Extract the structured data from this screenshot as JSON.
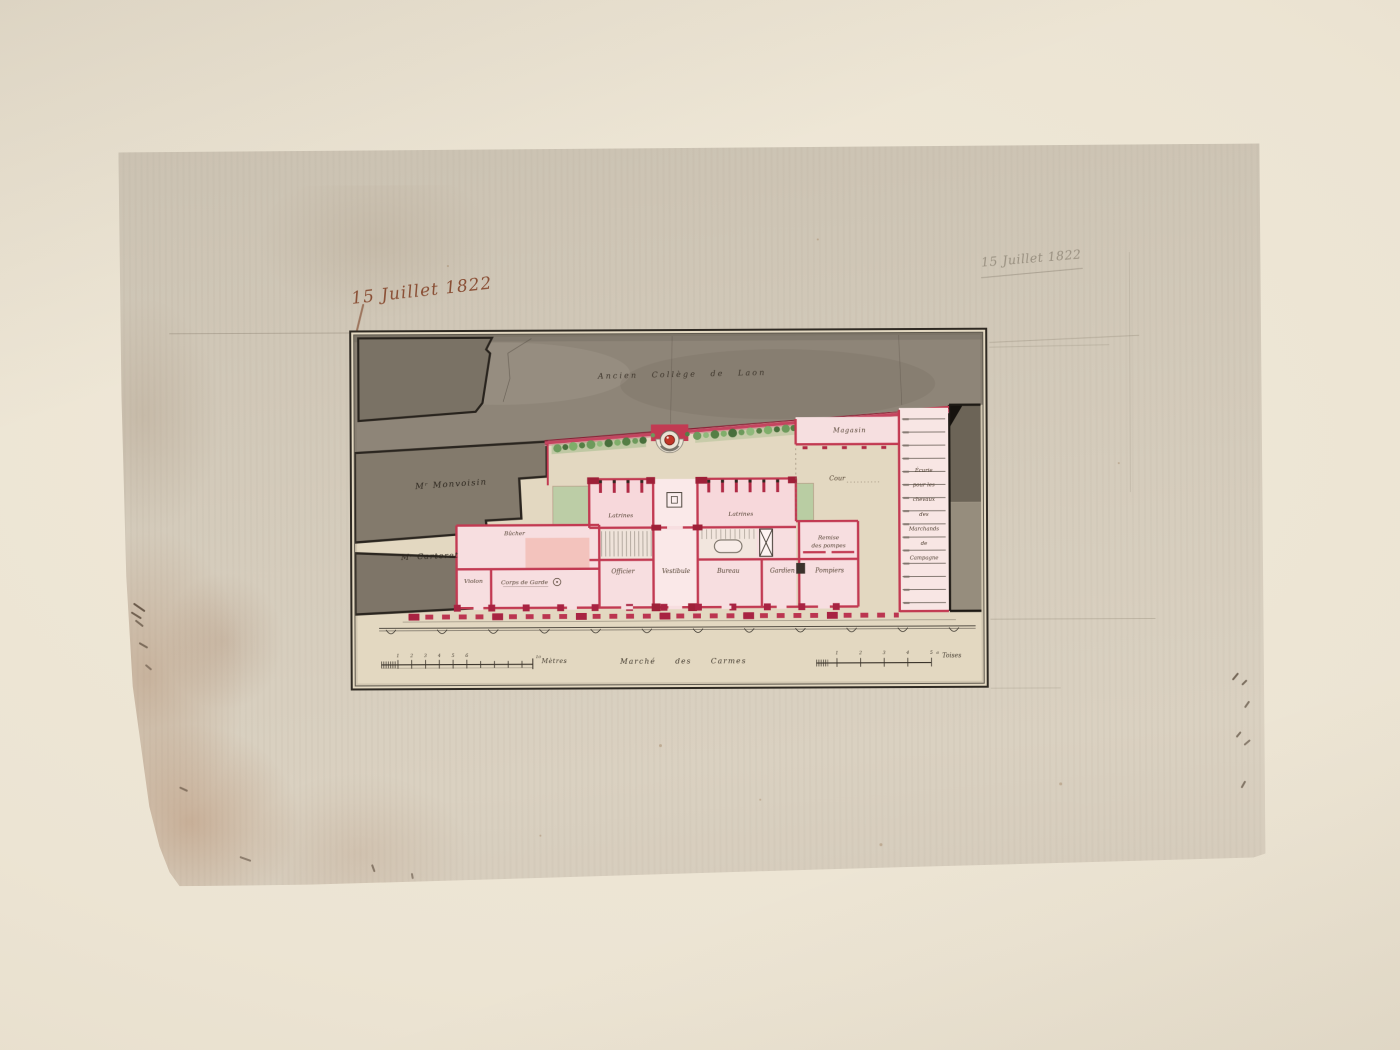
{
  "photo": {
    "inscriptions": {
      "date_ink": "15 Juillet 1822",
      "date_pencil": "15 Juillet 1822"
    },
    "plan": {
      "site_label": "Ancien Collège de Laon",
      "neighbor_left_upper": "Mʳ Monvoisin",
      "neighbor_left_lower": "Mʳ Carteret",
      "street_label": "Marché des Carmes",
      "rooms": {
        "bucher": "Bûcher",
        "violon": "Violon",
        "corps_de_garde": "Corps de Garde",
        "latrines_left": "Latrines",
        "latrines_right": "Latrines",
        "officier": "Officier",
        "vestibule": "Vestibule",
        "bureau": "Bureau",
        "gardien": "Gardien",
        "remise_line1": "Remise",
        "remise_line2": "des pompes",
        "pompiers": "Pompiers",
        "magasin": "Magasin",
        "cour": "Cour",
        "ecurie_lines": [
          "Écurie",
          "pour les",
          "chevaux",
          "des",
          "Marchands",
          "de",
          "Campagne"
        ]
      },
      "scale_left": {
        "numbers": [
          "1",
          "2",
          "3",
          "4",
          "5",
          "6"
        ],
        "end_value": "10",
        "unit": "Mètres"
      },
      "scale_right": {
        "numbers": [
          "1",
          "2",
          "3",
          "4",
          "5"
        ],
        "end_value": "6",
        "unit": "Toises"
      }
    },
    "colors": {
      "backdrop": "#ece5d5",
      "paper": "#d3c9b9",
      "drawing_paper": "#e3d8c1",
      "gray_wash": "#8e8578",
      "dark_parcel": "#7a7265",
      "wall_crimson": "#c23a52",
      "room_pink": "#f7dee0",
      "accent_red": "#a82342",
      "green_court": "#bccda6",
      "tree_green": "#5d8a4e",
      "label_ink": "#4f3e2e",
      "date_ink": "#8a4f35"
    }
  }
}
